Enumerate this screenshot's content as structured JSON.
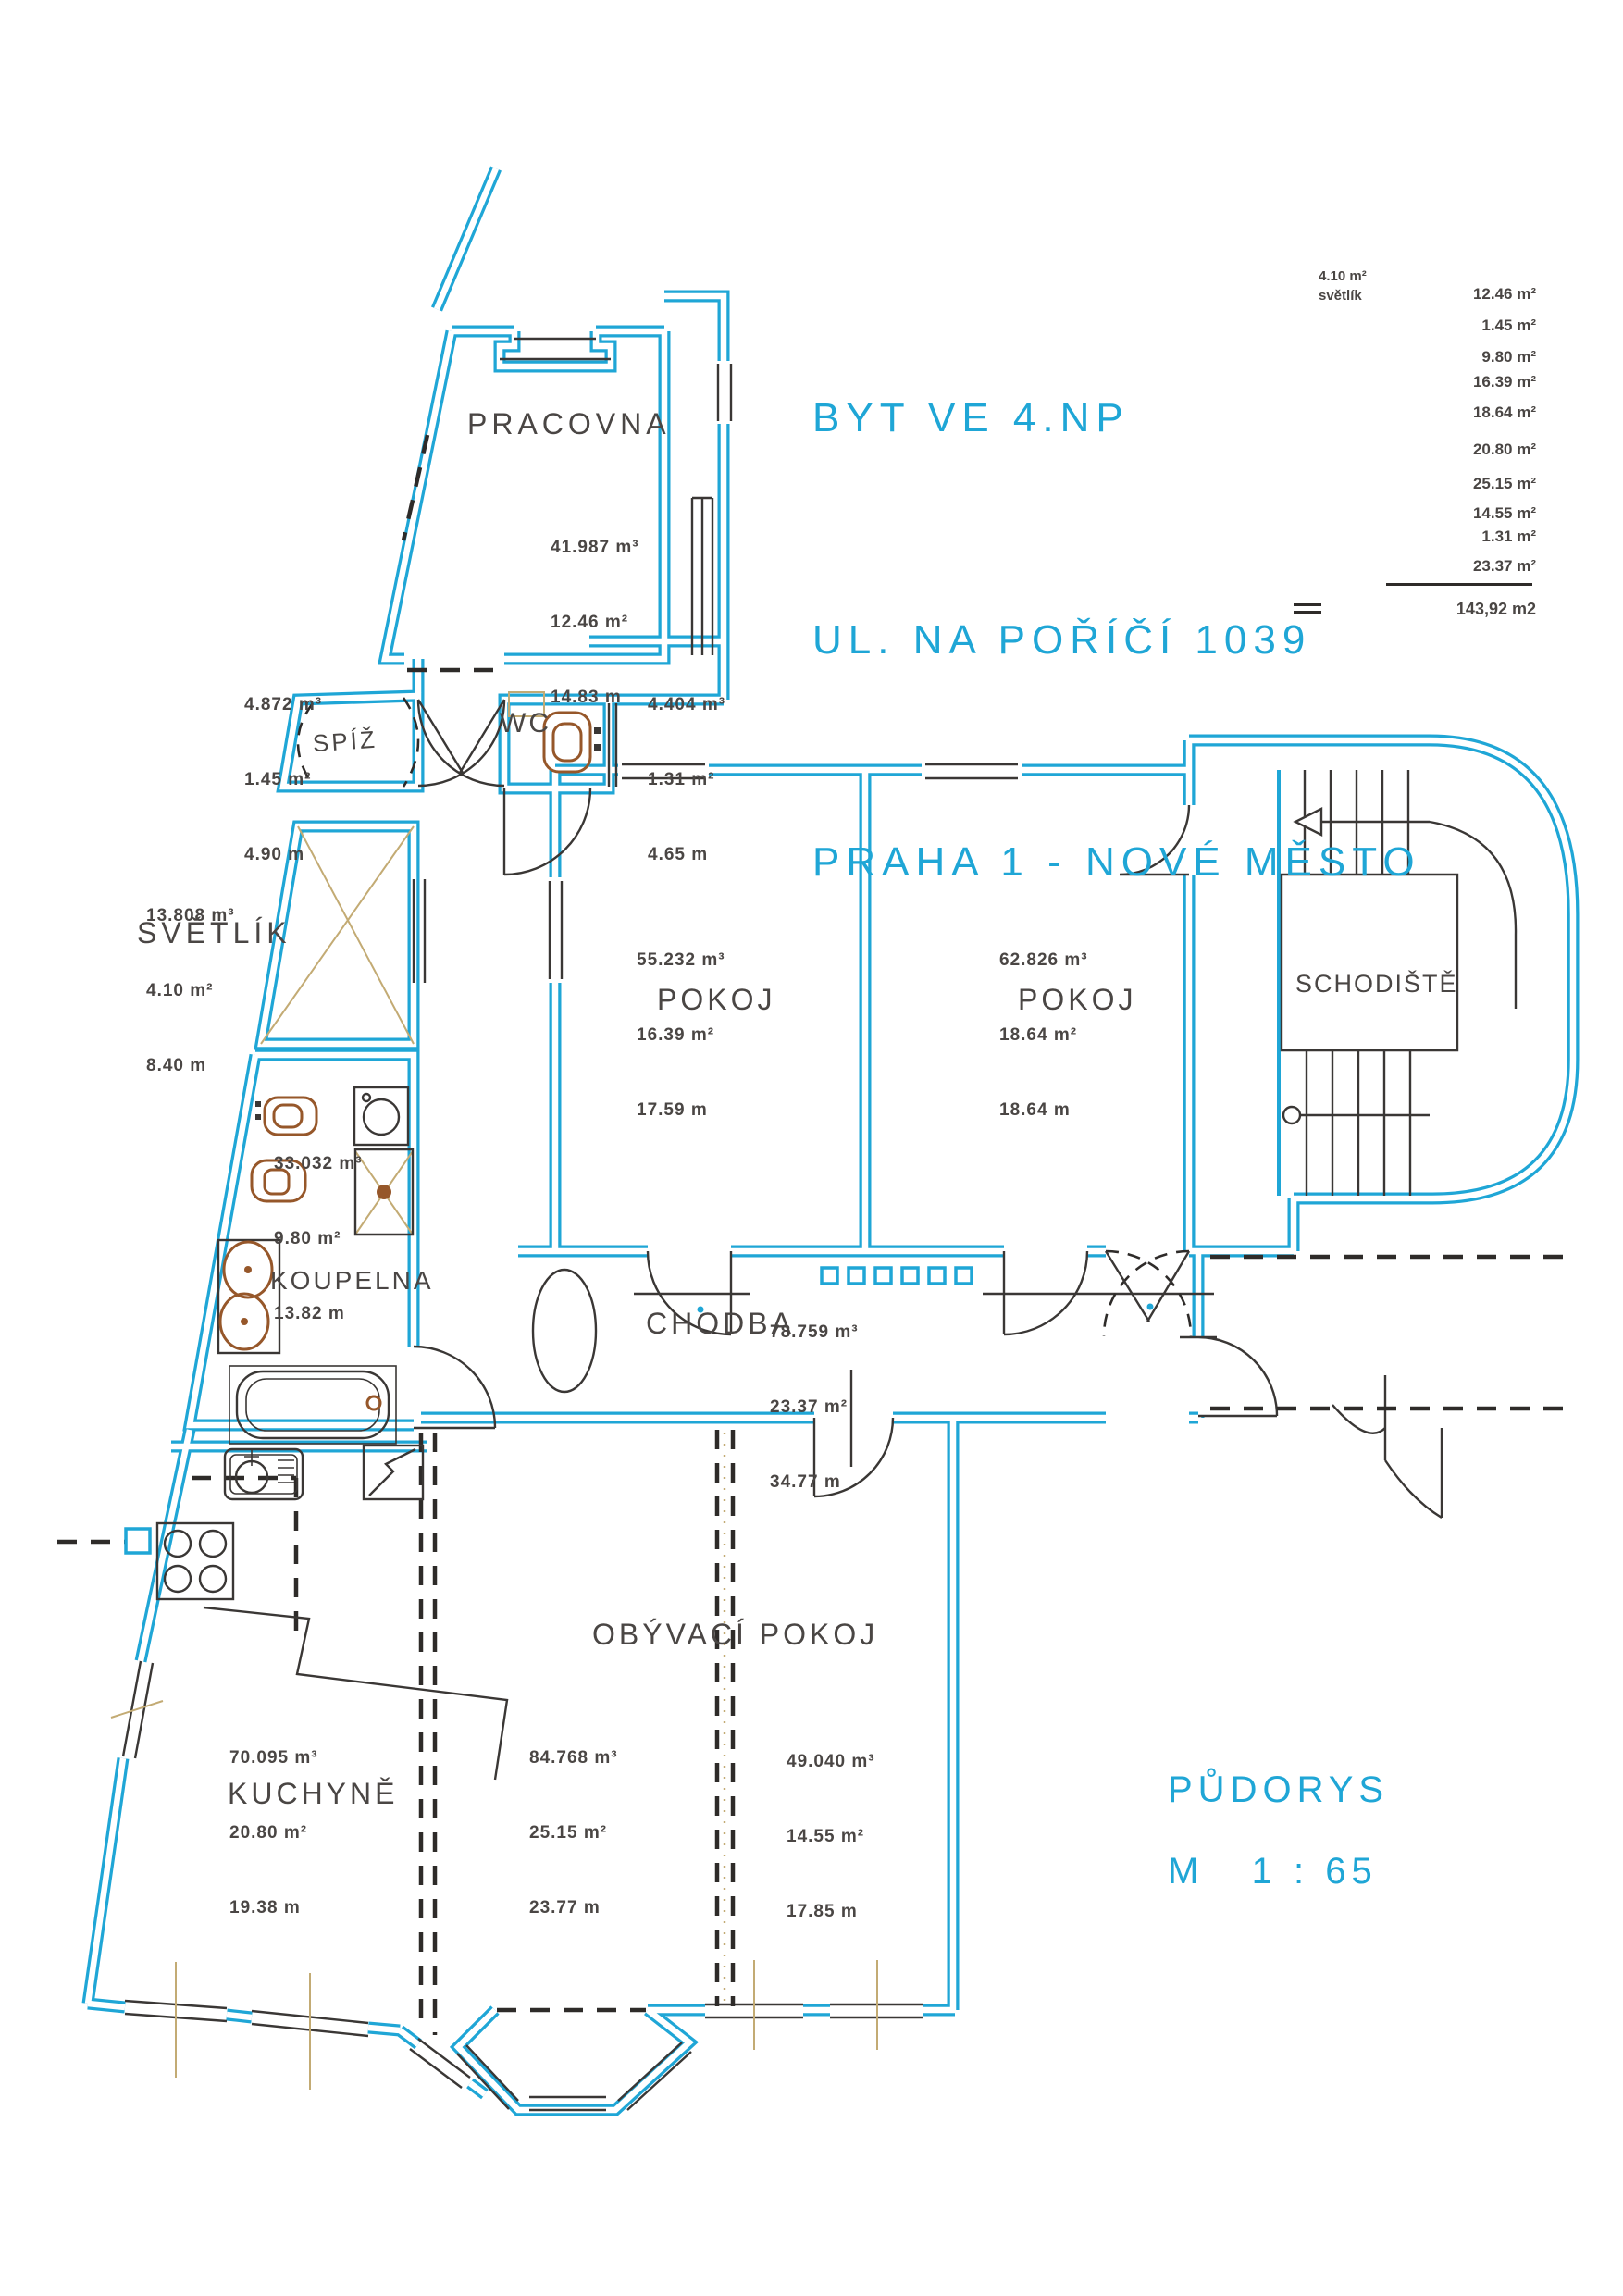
{
  "title": {
    "line1": "BYT VE 4.NP",
    "line2": "UL. NA POŘÍČÍ 1039",
    "line3": "PRAHA 1 - NOVÉ MĚSTO"
  },
  "summary": {
    "svetlik_area": "4.10 m²",
    "svetlik_label": "světlík",
    "areas": [
      "12.46 m²",
      "1.45 m²",
      "9.80 m²",
      "16.39 m²",
      "18.64 m²",
      "20.80 m²",
      "25.15 m²",
      "14.55 m²",
      "1.31 m²",
      "23.37 m²"
    ],
    "total": "143,92 m2"
  },
  "rooms": {
    "pracovna": {
      "label": "PRACOVNA",
      "volume": "41.987 m³",
      "area": "12.46 m²",
      "perimeter": "14.83 m"
    },
    "spiz": {
      "label": "SPÍŽ",
      "volume": "4.872 m³",
      "area": "1.45 m²",
      "perimeter": "4.90 m"
    },
    "wc": {
      "label": "WC",
      "volume": "4.404 m³",
      "area": "1.31 m²",
      "perimeter": "4.65 m"
    },
    "svetlik": {
      "label": "SVĚTLÍK",
      "volume": "13.808 m³",
      "area": "4.10 m²",
      "perimeter": "8.40 m"
    },
    "pokoj1": {
      "label": "POKOJ",
      "volume": "55.232 m³",
      "area": "16.39 m²",
      "perimeter": "17.59 m"
    },
    "pokoj2": {
      "label": "POKOJ",
      "volume": "62.826 m³",
      "area": "18.64 m²",
      "perimeter": "18.64 m"
    },
    "schodiste": {
      "label": "SCHODIŠTĚ"
    },
    "koupelna": {
      "label": "KOUPELNA",
      "volume": "33.032 m³",
      "area": "9.80 m²",
      "perimeter": "13.82 m"
    },
    "chodba": {
      "label": "CHODBA",
      "volume": "78.759 m³",
      "area": "23.37 m²",
      "perimeter": "34.77 m"
    },
    "kuchyne": {
      "label": "KUCHYNĚ",
      "volume": "70.095 m³",
      "area": "20.80 m²",
      "perimeter": "19.38 m"
    },
    "obyvaci": {
      "label": "OBÝVACÍ POKOJ",
      "left": {
        "volume": "84.768 m³",
        "area": "25.15 m²",
        "perimeter": "23.77 m"
      },
      "right": {
        "volume": "49.040 m³",
        "area": "14.55 m²",
        "perimeter": "17.85 m"
      }
    }
  },
  "footer": {
    "drawing_type": "PŮDORYS",
    "scale": "M   1 : 65"
  },
  "colors": {
    "plan_cyan": "#1FA6D6",
    "ink": "#4a4644",
    "tan": "#c3ab74",
    "fixture_brown": "#96572a"
  }
}
